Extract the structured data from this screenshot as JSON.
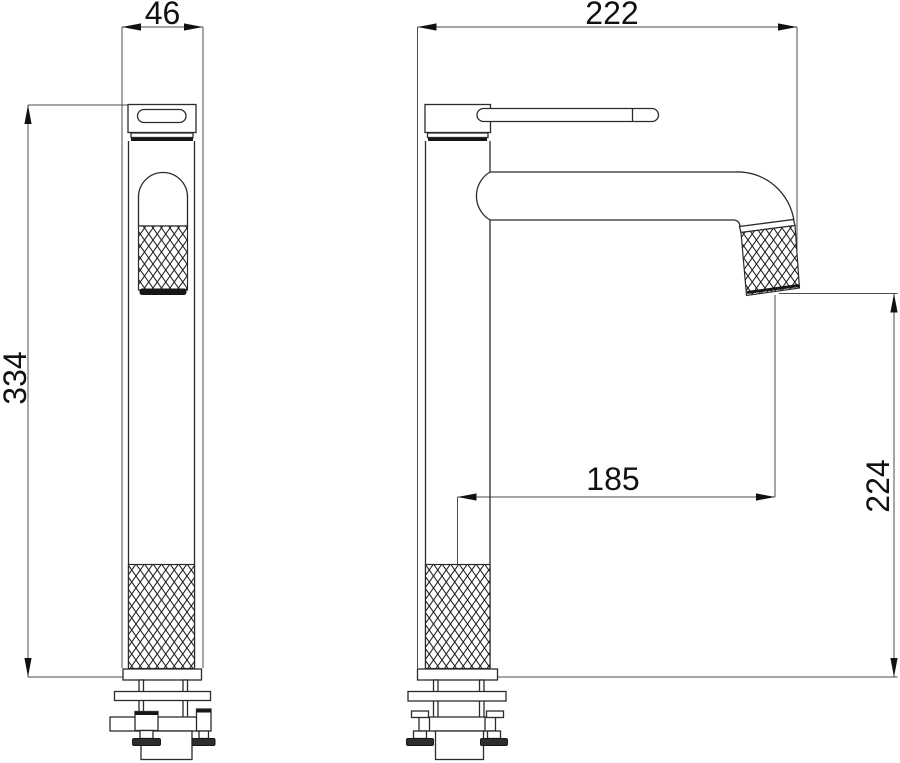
{
  "drawing": {
    "type": "technical-drawing",
    "subject": "Tall single-lever basin mixer tap — two-view dimensioned orthographic drawing",
    "views": {
      "front": {
        "width": "46",
        "height": "334"
      },
      "side": {
        "depth": "222",
        "spout_reach": "185",
        "outlet_height": "224"
      }
    },
    "colors": {
      "background": "#ffffff",
      "outline": "#2b2b2b",
      "dimension_line": "#4d4d4d",
      "text": "#111111"
    }
  }
}
